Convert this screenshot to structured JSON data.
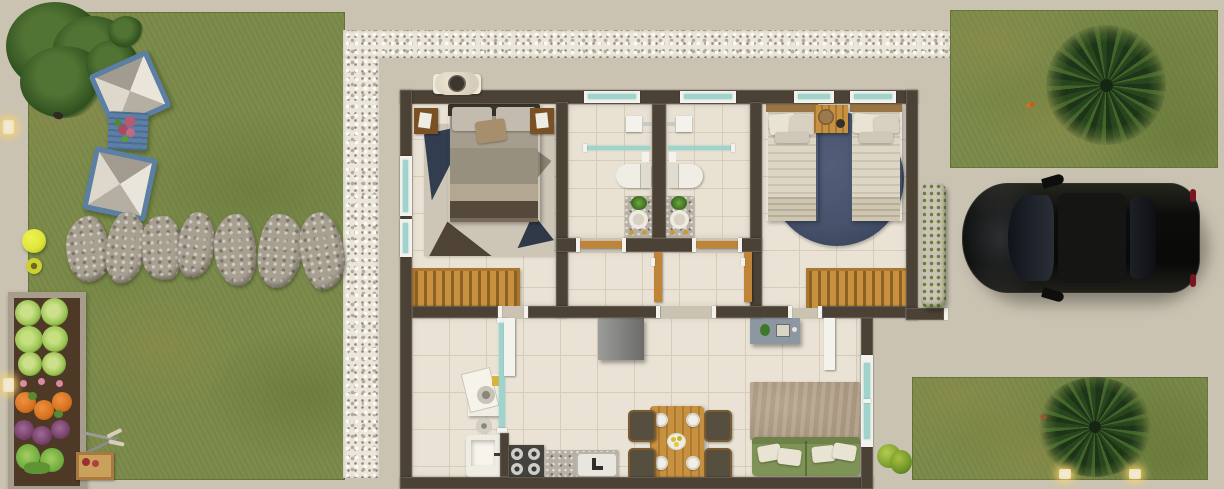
{
  "scene": {
    "description": "Top-down 3D architectural rendering of a small single-storey house floor plan with left garden lawn, white gravel border, right driveway with parked black SUV, hedges and palm trees",
    "width_px": 1224,
    "height_px": 489
  },
  "colors": {
    "sidewalk": "#cbc3b2",
    "lawn": "#7d8c4c",
    "gravel": "#ebe6da",
    "wall": "#4b4134",
    "tile": "#eae3d5",
    "tilebath": "#e9e1d2",
    "tileline": "#d6ccba",
    "trim": "#f4f2ec",
    "glass": "#9fd3cc",
    "wood": "#c8913f",
    "headboard": "#9a7544",
    "doorwood": "#c08438",
    "hedge": "#7db32e",
    "rug_blue": "#47536c",
    "rug_bed1": "#cdc5b6",
    "rug_living": "#a8957e",
    "sofa": "#7e9356",
    "pillow": "#e9e3d3",
    "car_body": "#121211",
    "granite": "#b6b0a4",
    "fridge": "#8d8d8b",
    "console": "#8c97a1",
    "soil": "#4e3826",
    "lettuce": "#9cc455",
    "pumpkin": "#d4721f",
    "cabbage": "#76406b",
    "daybed": "#5b7fa5",
    "stone": "#a7a091",
    "ball": "#dfe63a",
    "gold": "#c79a3a",
    "plant": "#4e8a32"
  },
  "garden_left": {
    "name": "back garden",
    "objects": [
      "shade tree",
      "lounge daybed",
      "blue side table with roses",
      "lounge daybed",
      "seven stepping stones",
      "yellow ball",
      "yellow pail",
      "raised vegetable bed",
      "garden shears",
      "harvest crate",
      "two warm path lights",
      "small bird"
    ],
    "vegetable_rows": [
      "lettuce",
      "flowers",
      "pumpkins",
      "red cabbage",
      "herbs"
    ]
  },
  "house": {
    "rooms": [
      {
        "name": "bedroom-1",
        "furniture": [
          "double bed",
          "two nightstands",
          "geometric rug",
          "slatted wood bench",
          "ac condenser outside",
          "two left-wall windows"
        ]
      },
      {
        "name": "bathroom-1",
        "furniture": [
          "shower head",
          "glass shower screen",
          "toilet",
          "granite vanity with plant and gold taps",
          "top window"
        ]
      },
      {
        "name": "bathroom-2",
        "furniture": [
          "shower head",
          "glass shower screen",
          "toilet",
          "granite vanity with plant and gold taps",
          "top window"
        ]
      },
      {
        "name": "hallway",
        "furniture": [
          "two open wooden bathroom doors"
        ]
      },
      {
        "name": "bedroom-2",
        "furniture": [
          "twin bed left",
          "twin bed right",
          "wood desk with tray",
          "round navy rug",
          "slatted wood bench",
          "two top windows"
        ]
      },
      {
        "name": "kitchen-living-dining",
        "furniture": [
          "washing machine",
          "laundry sink",
          "glass laundry partition",
          "gas cooktop",
          "granite counter with sink",
          "refrigerator",
          "dining table for four",
          "four chairs",
          "fruit bowl",
          "tv console",
          "area rug",
          "green sofa with four pillows",
          "sliding glass door"
        ]
      }
    ]
  },
  "driveway_right": {
    "objects": [
      "black suv seen from above",
      "boxwood hedge",
      "palm tree on upper lawn",
      "palm tree on lower lawn",
      "small bush",
      "two path lights",
      "butterfly"
    ]
  }
}
